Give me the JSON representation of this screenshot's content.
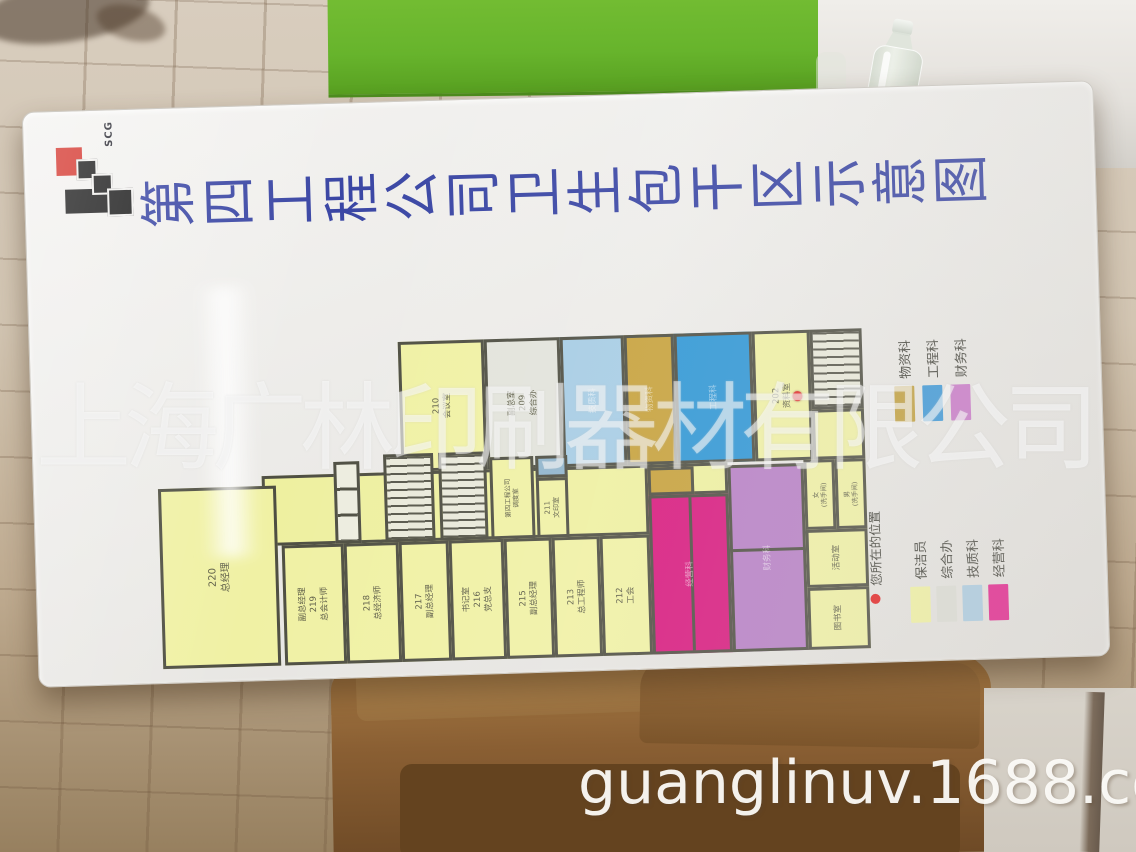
{
  "watermarks": {
    "company": "上海广林印刷器材有限公司",
    "site": "guanglinuv.1688.com"
  },
  "sign": {
    "logo": {
      "text": "SCG",
      "red": "#d4342c",
      "black": "#1c1c1c"
    },
    "title": "第四工程公司卫生包干区示意图",
    "title_color": "#3a46a4",
    "legend_departments": [
      {
        "label": "物资科",
        "color": "#c2a03c"
      },
      {
        "label": "工程科",
        "color": "#3c98d8"
      },
      {
        "label": "财务科",
        "color": "#c978c9"
      }
    ],
    "location_legend": {
      "label": "您所在的位置",
      "dot_color": "#e32222"
    },
    "legend_roles": [
      {
        "label": "保洁员",
        "color": "#f0f2a2"
      },
      {
        "label": "综合办",
        "color": "#dcddd5"
      },
      {
        "label": "技质科",
        "color": "#abcce1"
      },
      {
        "label": "经营科",
        "color": "#e31f8c"
      }
    ],
    "floorplan": {
      "wall_color": "#4e4e42",
      "marker": {
        "x": 646,
        "y": 78,
        "color": "#e32222"
      },
      "rooms": [
        {
          "name": "room-210",
          "text": "210\n会议室",
          "fill": "#f0f1a4",
          "x": 248,
          "y": 12,
          "w": 86,
          "h": 130
        },
        {
          "name": "room-209",
          "text": "副总室\n209\n综合办",
          "fill": "#e2e3db",
          "x": 334,
          "y": 12,
          "w": 76,
          "h": 130
        },
        {
          "name": "room-tech-dept",
          "text": "技质科",
          "fill": "#a6cce4",
          "x": 410,
          "y": 12,
          "w": 64,
          "h": 130,
          "faint": true
        },
        {
          "name": "room-material-dept",
          "text": "物资科",
          "fill": "#c6a13b",
          "x": 474,
          "y": 12,
          "w": 50,
          "h": 130,
          "faint": true
        },
        {
          "name": "room-engineering-dept",
          "text": "工程科",
          "fill": "#2e96d5",
          "x": 524,
          "y": 12,
          "w": 78,
          "h": 130,
          "faint": true
        },
        {
          "name": "room-202",
          "text": "202\n资料室",
          "fill": "#f0f1a4",
          "x": 602,
          "y": 12,
          "w": 58,
          "h": 130
        },
        {
          "name": "stairwell-top",
          "text": "",
          "x": 660,
          "y": 12,
          "w": 52,
          "h": 80,
          "type": "stair"
        },
        {
          "name": "room-storage-small",
          "text": "",
          "fill": "#f0f1a4",
          "x": 660,
          "y": 92,
          "w": 52,
          "h": 50
        },
        {
          "name": "corridor",
          "text": "",
          "fill": "#eef0a0",
          "x": 108,
          "y": 142,
          "w": 386,
          "h": 70
        },
        {
          "name": "corridor-right",
          "text": "",
          "fill": "#eef0a0",
          "x": 494,
          "y": 142,
          "w": 80,
          "h": 31
        },
        {
          "name": "elevator-bank",
          "text": "",
          "x": 180,
          "y": 130,
          "w": 26,
          "h": 82,
          "type": "cells"
        },
        {
          "name": "stairwell-a",
          "text": "",
          "x": 230,
          "y": 124,
          "w": 50,
          "h": 88,
          "type": "stair"
        },
        {
          "name": "stairwell-b",
          "text": "",
          "x": 285,
          "y": 124,
          "w": 48,
          "h": 88,
          "type": "stair"
        },
        {
          "name": "room-duty",
          "text": "第四工程公司\n调度室",
          "fill": "#f0f1a4",
          "x": 336,
          "y": 130,
          "w": 44,
          "h": 82,
          "fs": 6.5
        },
        {
          "name": "room-small-blue",
          "text": "",
          "fill": "#8fb4cc",
          "x": 382,
          "y": 130,
          "w": 32,
          "h": 22
        },
        {
          "name": "room-211",
          "text": "211\n文印室",
          "fill": "#f0f1a4",
          "x": 382,
          "y": 152,
          "w": 32,
          "h": 60,
          "fs": 7
        },
        {
          "name": "room-small-gold",
          "text": "",
          "fill": "#c6a13b",
          "x": 494,
          "y": 145,
          "w": 46,
          "h": 28
        },
        {
          "name": "room-220",
          "text": "220\n总经理",
          "fill": "#f0f1a4",
          "x": 4,
          "y": 152,
          "w": 118,
          "h": 180,
          "fs": 10
        },
        {
          "name": "room-219",
          "text": "副总经理\n219\n总会计师",
          "fill": "#f0f1a4",
          "x": 126,
          "y": 212,
          "w": 62,
          "h": 120
        },
        {
          "name": "room-218",
          "text": "218\n总经济师",
          "fill": "#f0f1a4",
          "x": 188,
          "y": 212,
          "w": 55,
          "h": 120
        },
        {
          "name": "room-217",
          "text": "217\n副总经理",
          "fill": "#f0f1a4",
          "x": 243,
          "y": 212,
          "w": 50,
          "h": 120
        },
        {
          "name": "room-216",
          "text": "书记室\n216\n党总支",
          "fill": "#f0f1a4",
          "x": 293,
          "y": 212,
          "w": 55,
          "h": 120
        },
        {
          "name": "room-215",
          "text": "215\n副总经理",
          "fill": "#f0f1a4",
          "x": 348,
          "y": 212,
          "w": 48,
          "h": 120
        },
        {
          "name": "room-213",
          "text": "213\n总工程师",
          "fill": "#f0f1a4",
          "x": 396,
          "y": 212,
          "w": 48,
          "h": 120
        },
        {
          "name": "room-212",
          "text": "212\n工会",
          "fill": "#f0f1a4",
          "x": 444,
          "y": 212,
          "w": 50,
          "h": 120
        },
        {
          "name": "room-business-dept",
          "text": "经营科",
          "fill": "#d8187e",
          "x": 494,
          "y": 173,
          "w": 80,
          "h": 159,
          "faint": true,
          "divider": "v"
        },
        {
          "name": "room-finance-dept",
          "text": "财务科",
          "fill": "#b77fc6",
          "x": 574,
          "y": 145,
          "w": 76,
          "h": 187,
          "faint": true,
          "divider": "h"
        },
        {
          "name": "toilet-women",
          "text": "女\n(洗手间)",
          "fill": "#f0f1a4",
          "x": 650,
          "y": 142,
          "w": 31,
          "h": 70,
          "fs": 6.5
        },
        {
          "name": "toilet-men",
          "text": "男\n(洗手间)",
          "fill": "#f0f1a4",
          "x": 681,
          "y": 142,
          "w": 31,
          "h": 70,
          "fs": 6.5
        },
        {
          "name": "room-activity",
          "text": "活动室",
          "fill": "#f0f1a4",
          "x": 650,
          "y": 212,
          "w": 62,
          "h": 58
        },
        {
          "name": "room-library",
          "text": "图书室",
          "fill": "#f0f1a4",
          "x": 650,
          "y": 270,
          "w": 62,
          "h": 62
        }
      ]
    }
  }
}
